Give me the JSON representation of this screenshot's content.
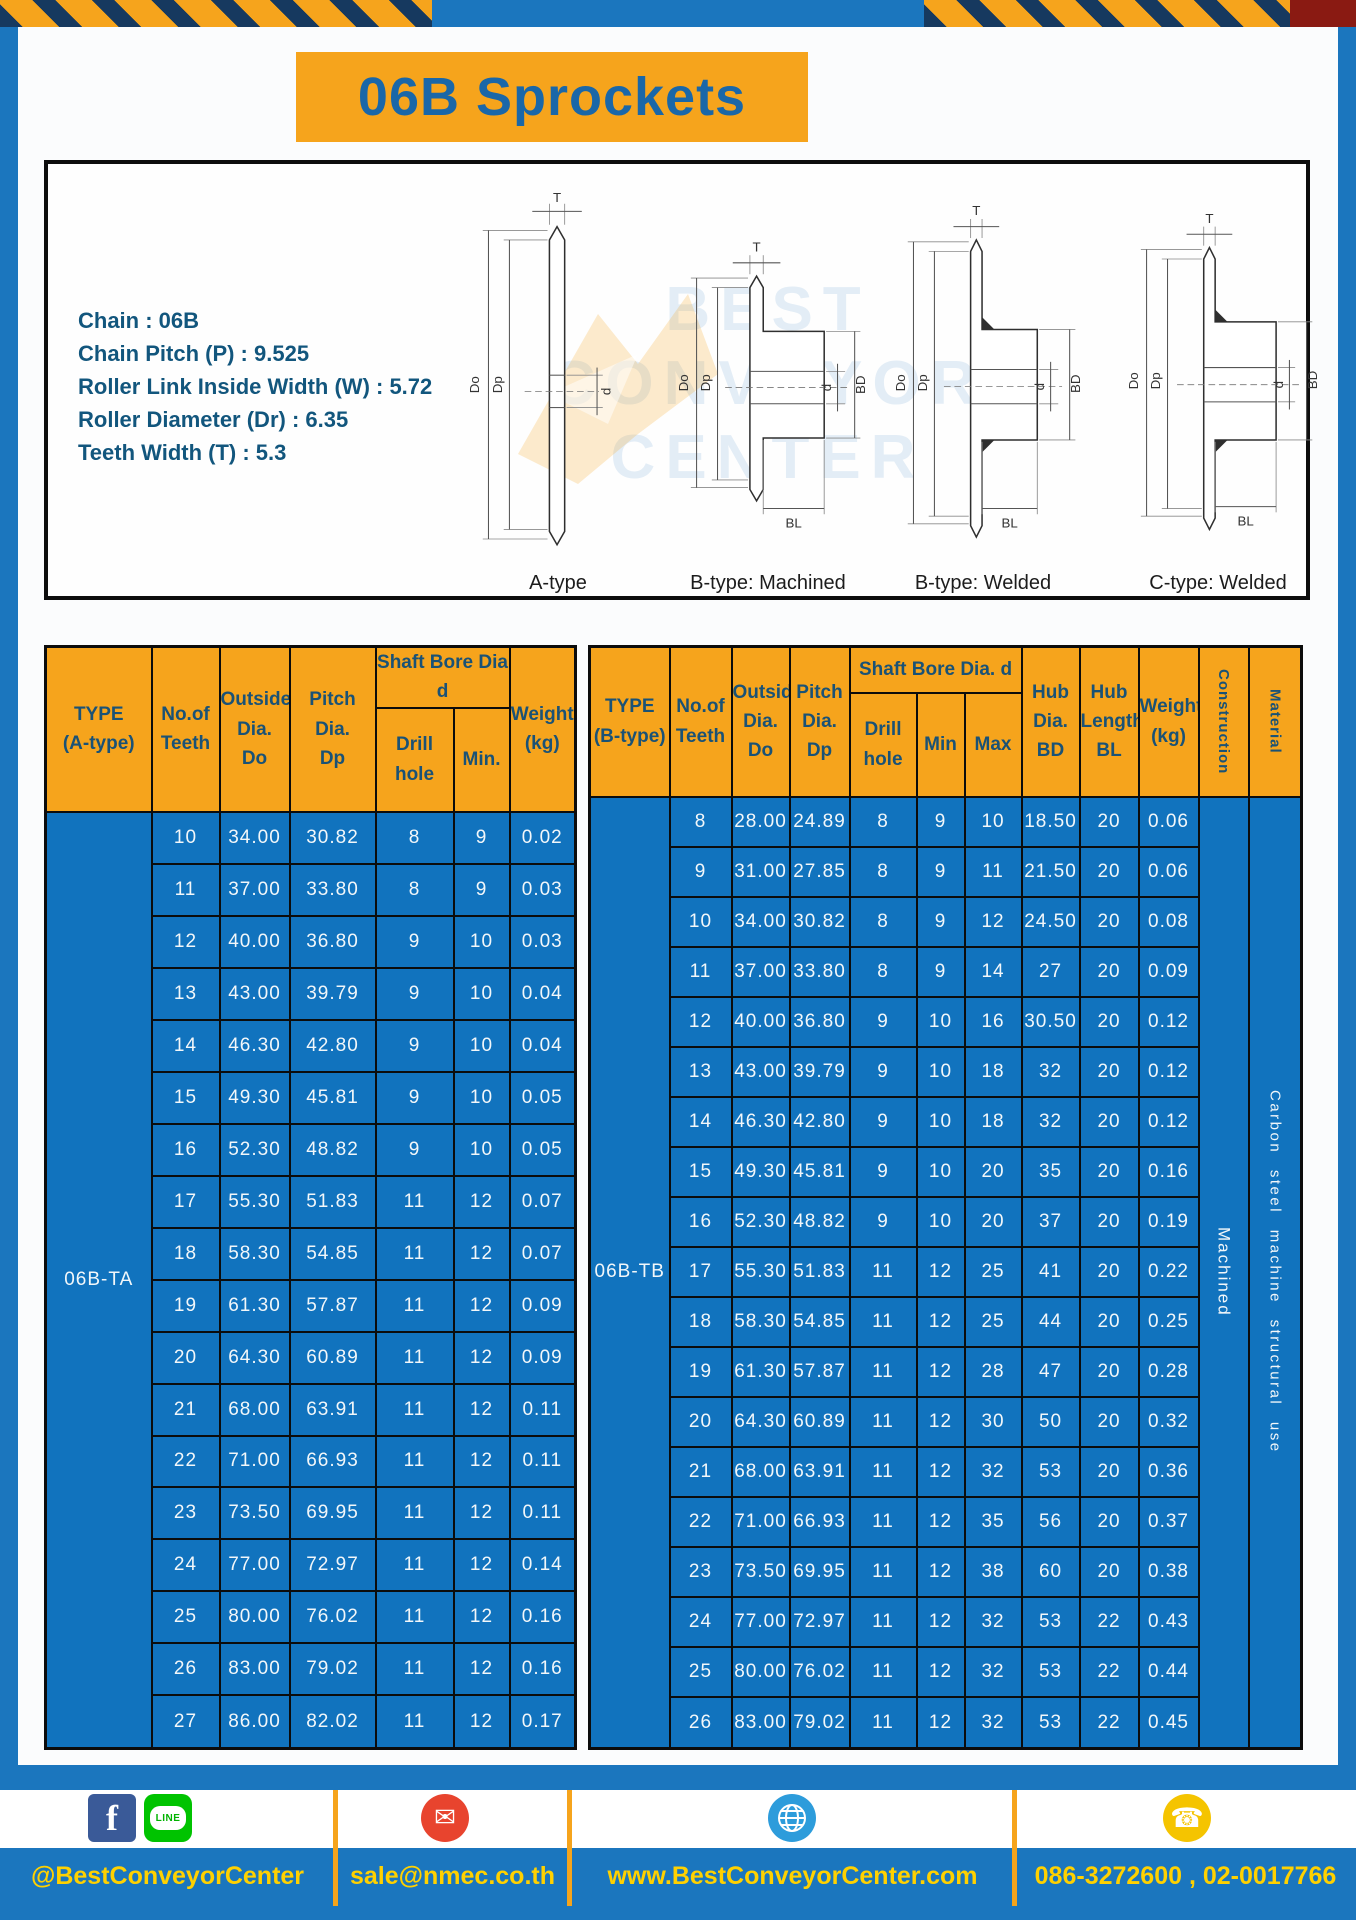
{
  "title": "06B Sprockets",
  "specs": {
    "lines": [
      "Chain : 06B",
      "Chain Pitch (P) : 9.525",
      "Roller Link Inside Width (W) : 5.72",
      "Roller Diameter (Dr) : 6.35",
      "Teeth Width (T) : 5.3"
    ]
  },
  "diagrams": {
    "captions": [
      "A-type",
      "B-type: Machined",
      "B-type: Welded",
      "C-type: Welded"
    ],
    "labels": {
      "t": "T",
      "dd": "Do",
      "dp": "Dp",
      "d": "d",
      "bd": "BD",
      "bl": "BL"
    },
    "watermark": {
      "line1": "BEST",
      "line2": "CONVEYOR",
      "line3": "CENTER"
    }
  },
  "left_table": {
    "headers": {
      "type": "TYPE\n(A-type)",
      "teeth": "No.of\nTeeth",
      "outside": "Outside\nDia.\nDo",
      "pitch": "Pitch Dia.\nDp",
      "shaft_group": "Shaft Bore Dia d",
      "drill": "Drill hole",
      "min": "Min.",
      "weight": "Weight\n(kg)"
    },
    "type_label": "06B-TA",
    "rows": [
      [
        "10",
        "34.00",
        "30.82",
        "8",
        "9",
        "0.02"
      ],
      [
        "11",
        "37.00",
        "33.80",
        "8",
        "9",
        "0.03"
      ],
      [
        "12",
        "40.00",
        "36.80",
        "9",
        "10",
        "0.03"
      ],
      [
        "13",
        "43.00",
        "39.79",
        "9",
        "10",
        "0.04"
      ],
      [
        "14",
        "46.30",
        "42.80",
        "9",
        "10",
        "0.04"
      ],
      [
        "15",
        "49.30",
        "45.81",
        "9",
        "10",
        "0.05"
      ],
      [
        "16",
        "52.30",
        "48.82",
        "9",
        "10",
        "0.05"
      ],
      [
        "17",
        "55.30",
        "51.83",
        "11",
        "12",
        "0.07"
      ],
      [
        "18",
        "58.30",
        "54.85",
        "11",
        "12",
        "0.07"
      ],
      [
        "19",
        "61.30",
        "57.87",
        "11",
        "12",
        "0.09"
      ],
      [
        "20",
        "64.30",
        "60.89",
        "11",
        "12",
        "0.09"
      ],
      [
        "21",
        "68.00",
        "63.91",
        "11",
        "12",
        "0.11"
      ],
      [
        "22",
        "71.00",
        "66.93",
        "11",
        "12",
        "0.11"
      ],
      [
        "23",
        "73.50",
        "69.95",
        "11",
        "12",
        "0.11"
      ],
      [
        "24",
        "77.00",
        "72.97",
        "11",
        "12",
        "0.14"
      ],
      [
        "25",
        "80.00",
        "76.02",
        "11",
        "12",
        "0.16"
      ],
      [
        "26",
        "83.00",
        "79.02",
        "11",
        "12",
        "0.16"
      ],
      [
        "27",
        "86.00",
        "82.02",
        "11",
        "12",
        "0.17"
      ]
    ]
  },
  "right_table": {
    "headers": {
      "type": "TYPE\n(B-type)",
      "teeth": "No.of\nTeeth",
      "outside": "Outside\nDia.\nDo",
      "pitch": "Pitch\nDia.\nDp",
      "shaft_group": "Shaft Bore Dia.  d",
      "drill": "Drill hole",
      "min": "Min",
      "max": "Max",
      "hub_dia": "Hub\nDia.\nBD",
      "hub_len": "Hub\nLength\nBL",
      "weight": "Weight\n(kg)",
      "construction": "Construction",
      "material": "Material"
    },
    "type_label": "06B-TB",
    "construction": "Machined",
    "material": "Carbon steel machine structural use",
    "rows": [
      [
        "8",
        "28.00",
        "24.89",
        "8",
        "9",
        "10",
        "18.50",
        "20",
        "0.06"
      ],
      [
        "9",
        "31.00",
        "27.85",
        "8",
        "9",
        "11",
        "21.50",
        "20",
        "0.06"
      ],
      [
        "10",
        "34.00",
        "30.82",
        "8",
        "9",
        "12",
        "24.50",
        "20",
        "0.08"
      ],
      [
        "11",
        "37.00",
        "33.80",
        "8",
        "9",
        "14",
        "27",
        "20",
        "0.09"
      ],
      [
        "12",
        "40.00",
        "36.80",
        "9",
        "10",
        "16",
        "30.50",
        "20",
        "0.12"
      ],
      [
        "13",
        "43.00",
        "39.79",
        "9",
        "10",
        "18",
        "32",
        "20",
        "0.12"
      ],
      [
        "14",
        "46.30",
        "42.80",
        "9",
        "10",
        "18",
        "32",
        "20",
        "0.12"
      ],
      [
        "15",
        "49.30",
        "45.81",
        "9",
        "10",
        "20",
        "35",
        "20",
        "0.16"
      ],
      [
        "16",
        "52.30",
        "48.82",
        "9",
        "10",
        "20",
        "37",
        "20",
        "0.19"
      ],
      [
        "17",
        "55.30",
        "51.83",
        "11",
        "12",
        "25",
        "41",
        "20",
        "0.22"
      ],
      [
        "18",
        "58.30",
        "54.85",
        "11",
        "12",
        "25",
        "44",
        "20",
        "0.25"
      ],
      [
        "19",
        "61.30",
        "57.87",
        "11",
        "12",
        "28",
        "47",
        "20",
        "0.28"
      ],
      [
        "20",
        "64.30",
        "60.89",
        "11",
        "12",
        "30",
        "50",
        "20",
        "0.32"
      ],
      [
        "21",
        "68.00",
        "63.91",
        "11",
        "12",
        "32",
        "53",
        "20",
        "0.36"
      ],
      [
        "22",
        "71.00",
        "66.93",
        "11",
        "12",
        "35",
        "56",
        "20",
        "0.37"
      ],
      [
        "23",
        "73.50",
        "69.95",
        "11",
        "12",
        "38",
        "60",
        "20",
        "0.38"
      ],
      [
        "24",
        "77.00",
        "72.97",
        "11",
        "12",
        "32",
        "53",
        "22",
        "0.43"
      ],
      [
        "25",
        "80.00",
        "76.02",
        "11",
        "12",
        "32",
        "53",
        "22",
        "0.44"
      ],
      [
        "26",
        "83.00",
        "79.02",
        "11",
        "12",
        "32",
        "53",
        "22",
        "0.45"
      ]
    ]
  },
  "footer": {
    "social_text": "@BestConveyorCenter",
    "email": "sale@nmec.co.th",
    "website": "www.BestConveyorCenter.com",
    "phone": "086-3272600 , 02-0017766",
    "facebook_letter": "f",
    "line_label": "LINE",
    "mail_glyph": "✉",
    "phone_glyph": "☎"
  },
  "colors": {
    "frame_blue": "#1B76BE",
    "table_blue": "#1173BE",
    "accent_yellow": "#F6A41C",
    "header_text": "#1A5276",
    "footer_text": "#FFD100",
    "hazard_navy": "#16395F"
  }
}
